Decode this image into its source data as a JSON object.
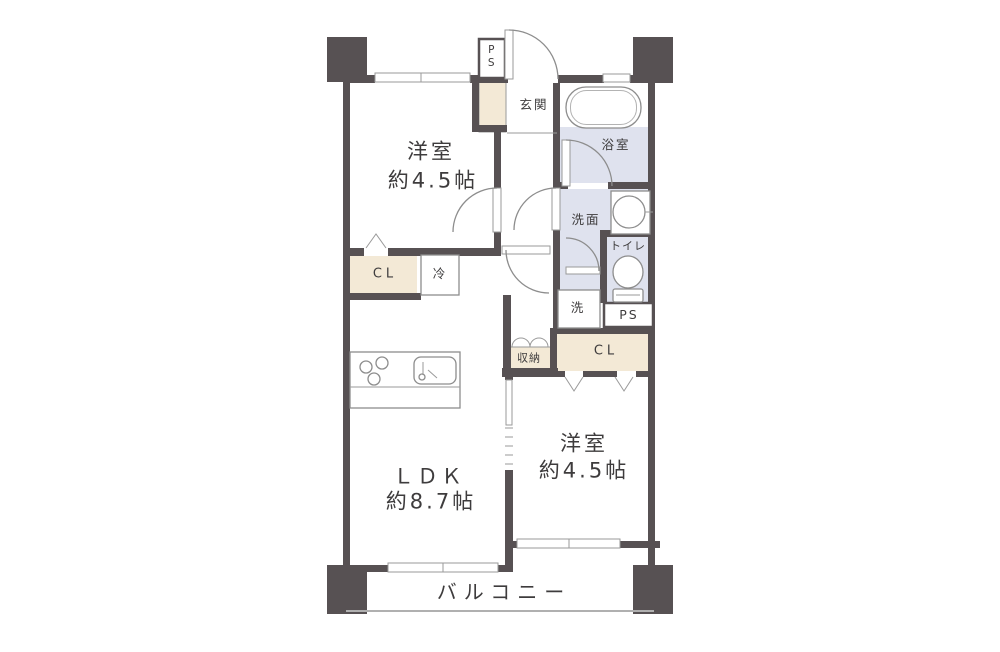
{
  "labels": {
    "western_top_name": "洋室",
    "western_top_size": "約4.5帖",
    "ldk_name": "ＬＤＫ",
    "ldk_size": "約8.7帖",
    "western_bottom_name": "洋室",
    "western_bottom_size": "約4.5帖",
    "balcony": "バルコニー",
    "entrance": "玄関",
    "bathroom": "浴室",
    "washroom": "洗面",
    "toilet": "トイレ",
    "laundry": "洗",
    "storage": "収納",
    "closet_left": "CL",
    "closet_right": "CL",
    "fridge": "冷",
    "pipe_space_top": "PS",
    "pipe_space_right": "PS"
  },
  "colors": {
    "wall": "#575153",
    "wet_area": "#dfe2ee",
    "closet": "#f3e9d6",
    "fixture_outline": "#8d8d8d",
    "text": "#3e3c3d",
    "background": "#ffffff"
  }
}
